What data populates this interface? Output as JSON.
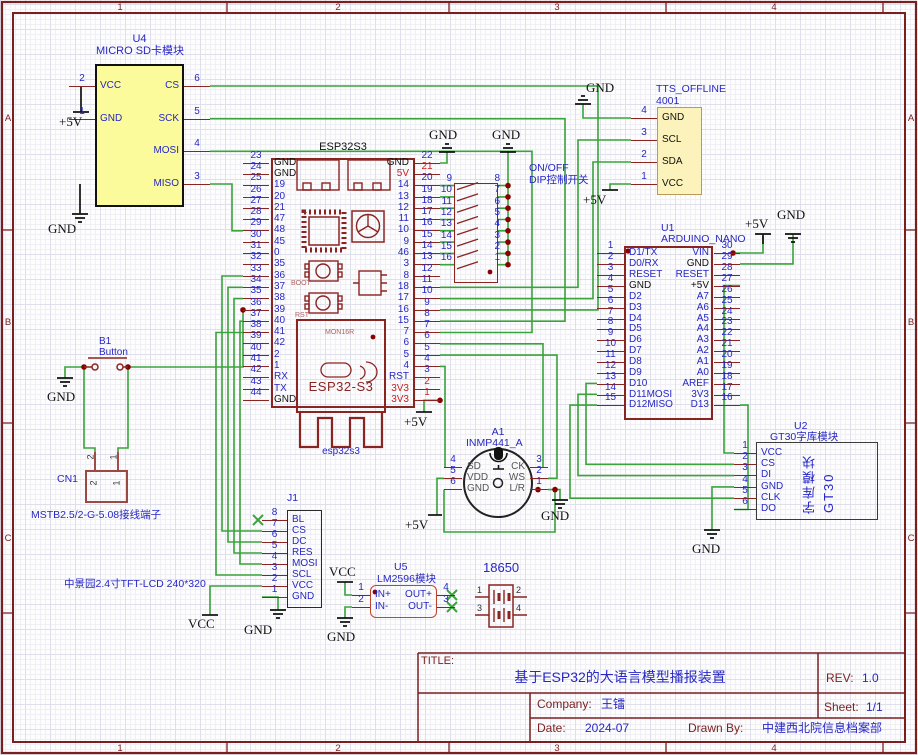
{
  "sheet": {
    "cols": [
      "1",
      "2",
      "3",
      "4"
    ],
    "rows": [
      "A",
      "B",
      "C"
    ]
  },
  "nets": {
    "gnd": "GND",
    "p5v": "+5V",
    "vcc": "VCC"
  },
  "tb": {
    "title_label": "TITLE:",
    "title": "基于ESP32的大语言模型播报装置",
    "rev_label": "REV:",
    "rev": "1.0",
    "company_label": "Company:",
    "company": "王镭",
    "sheet_label": "Sheet:",
    "sheet": "1/1",
    "date_label": "Date:",
    "date": "2024-07",
    "drawn_label": "Drawn By:",
    "drawn": "中建西北院信息档案部"
  },
  "u4": {
    "ref": "U4",
    "name": "MICRO SD卡模块",
    "left": [
      {
        "n": "2",
        "l": "VCC"
      },
      {
        "n": "1",
        "l": "GND"
      }
    ],
    "right": [
      {
        "n": "6",
        "l": "CS"
      },
      {
        "n": "5",
        "l": "SCK"
      },
      {
        "n": "4",
        "l": "MOSI"
      },
      {
        "n": "3",
        "l": "MISO"
      }
    ]
  },
  "esp32": {
    "header": "ESP32S3",
    "module_text": "ESP32-S3",
    "module_sub": "esp32s3",
    "logo_text": "MON16R",
    "boot": "BOOT",
    "rst": "RST",
    "left": [
      {
        "n": "23",
        "l": "GND",
        "lc": "k"
      },
      {
        "n": "24",
        "l": "GND",
        "lc": "k"
      },
      {
        "n": "25",
        "l": "19"
      },
      {
        "n": "26",
        "l": "20"
      },
      {
        "n": "27",
        "l": "21"
      },
      {
        "n": "28",
        "l": "47"
      },
      {
        "n": "29",
        "l": "48"
      },
      {
        "n": "30",
        "l": "45"
      },
      {
        "n": "31",
        "l": "0"
      },
      {
        "n": "32",
        "l": "35"
      },
      {
        "n": "33",
        "l": "36"
      },
      {
        "n": "34",
        "l": "37"
      },
      {
        "n": "35",
        "l": "38"
      },
      {
        "n": "36",
        "l": "39"
      },
      {
        "n": "37",
        "l": "40"
      },
      {
        "n": "38",
        "l": "41"
      },
      {
        "n": "39",
        "l": "42"
      },
      {
        "n": "40",
        "l": "2"
      },
      {
        "n": "41",
        "l": "1"
      },
      {
        "n": "42",
        "l": "RX"
      },
      {
        "n": "43",
        "l": "TX"
      },
      {
        "n": "44",
        "l": "GND",
        "lc": "k"
      }
    ],
    "right": [
      {
        "n": "22",
        "l": "GND",
        "lc": "k"
      },
      {
        "n": "21",
        "l": "5V",
        "nc": "r",
        "lc": "r"
      },
      {
        "n": "20",
        "l": "14"
      },
      {
        "n": "19",
        "l": "13"
      },
      {
        "n": "18",
        "l": "12"
      },
      {
        "n": "17",
        "l": "11"
      },
      {
        "n": "16",
        "l": "10"
      },
      {
        "n": "15",
        "l": "9"
      },
      {
        "n": "14",
        "l": "46"
      },
      {
        "n": "13",
        "l": "3"
      },
      {
        "n": "12",
        "l": "8"
      },
      {
        "n": "11",
        "l": "18"
      },
      {
        "n": "10",
        "l": "17"
      },
      {
        "n": "9",
        "l": "16"
      },
      {
        "n": "8",
        "l": "15"
      },
      {
        "n": "7",
        "l": "7"
      },
      {
        "n": "6",
        "l": "6"
      },
      {
        "n": "5",
        "l": "5"
      },
      {
        "n": "4",
        "l": "4"
      },
      {
        "n": "3",
        "l": "RST"
      },
      {
        "n": "2",
        "l": "3V3",
        "nc": "r",
        "lc": "r"
      },
      {
        "n": "1",
        "l": "3V3",
        "nc": "r",
        "lc": "r"
      }
    ]
  },
  "dip": {
    "label1": "ON/OFF",
    "label2": "DIP控制开关",
    "left": [
      {
        "n": "9"
      },
      {
        "n": "10"
      },
      {
        "n": "11"
      },
      {
        "n": "12"
      },
      {
        "n": "13"
      },
      {
        "n": "14"
      },
      {
        "n": "15"
      },
      {
        "n": "16"
      }
    ],
    "right": [
      {
        "n": "8"
      },
      {
        "n": "7"
      },
      {
        "n": "6"
      },
      {
        "n": "5"
      },
      {
        "n": "4"
      },
      {
        "n": "3"
      },
      {
        "n": "2"
      },
      {
        "n": "1"
      }
    ]
  },
  "tts": {
    "ref": "TTS_OFFLINE",
    "name": "4001",
    "pins": [
      {
        "n": "4",
        "l": "GND",
        "lc": "k"
      },
      {
        "n": "3",
        "l": "SCL",
        "lc": "k"
      },
      {
        "n": "2",
        "l": "SDA",
        "lc": "k"
      },
      {
        "n": "1",
        "l": "VCC",
        "lc": "k"
      }
    ]
  },
  "arduino": {
    "ref": "U1",
    "name": "ARDUINO_NANO",
    "left": [
      {
        "n": "1",
        "l": "D1/TX"
      },
      {
        "n": "2",
        "l": "D0/RX"
      },
      {
        "n": "3",
        "l": "RESET"
      },
      {
        "n": "4",
        "l": "GND",
        "lc": "k"
      },
      {
        "n": "5",
        "l": "D2"
      },
      {
        "n": "6",
        "l": "D3"
      },
      {
        "n": "7",
        "l": "D4"
      },
      {
        "n": "8",
        "l": "D5"
      },
      {
        "n": "9",
        "l": "D6"
      },
      {
        "n": "10",
        "l": "D7"
      },
      {
        "n": "11",
        "l": "D8"
      },
      {
        "n": "12",
        "l": "D9"
      },
      {
        "n": "13",
        "l": "D10"
      },
      {
        "n": "14",
        "l": "D11MOSI"
      },
      {
        "n": "15",
        "l": "D12MISO"
      }
    ],
    "right": [
      {
        "n": "30",
        "l": "VIN"
      },
      {
        "n": "29",
        "l": "GND",
        "lc": "k"
      },
      {
        "n": "28",
        "l": "RESET"
      },
      {
        "n": "27",
        "l": "+5V",
        "lc": "k"
      },
      {
        "n": "26",
        "l": "A7"
      },
      {
        "n": "25",
        "l": "A6"
      },
      {
        "n": "24",
        "l": "A5"
      },
      {
        "n": "23",
        "l": "A4"
      },
      {
        "n": "22",
        "l": "A3"
      },
      {
        "n": "21",
        "l": "A2"
      },
      {
        "n": "20",
        "l": "A1"
      },
      {
        "n": "19",
        "l": "A0"
      },
      {
        "n": "18",
        "l": "AREF"
      },
      {
        "n": "17",
        "l": "3V3"
      },
      {
        "n": "16",
        "l": "D13"
      }
    ]
  },
  "gt30": {
    "ref": "U2",
    "name": "GT30字库模块",
    "body1": "字库模块",
    "body2": "GT30",
    "pins": [
      {
        "n": "1",
        "l": "VCC"
      },
      {
        "n": "2",
        "l": "CS"
      },
      {
        "n": "3",
        "l": "DI"
      },
      {
        "n": "4",
        "l": "GND"
      },
      {
        "n": "5",
        "l": "CLK"
      },
      {
        "n": "6",
        "l": "DO"
      }
    ]
  },
  "mic": {
    "ref": "A1",
    "name": "INMP441_A",
    "left": [
      {
        "n": "4",
        "l": "SD",
        "lc": "g"
      },
      {
        "n": "5",
        "l": "VDD",
        "lc": "g"
      },
      {
        "n": "6",
        "l": "GND",
        "lc": "g"
      }
    ],
    "right": [
      {
        "n": "3",
        "l": "CK",
        "lc": "g"
      },
      {
        "n": "2",
        "l": "WS",
        "lc": "g"
      },
      {
        "n": "1",
        "l": "L/R",
        "lc": "g"
      }
    ]
  },
  "button": {
    "ref": "B1",
    "name": "Button"
  },
  "cn1": {
    "ref": "CN1",
    "desc": "MSTB2.5/2-G-5.08接线端子",
    "p2": "2",
    "p1": "1"
  },
  "j1": {
    "ref": "J1",
    "desc": "中景园2.4寸TFT-LCD 240*320",
    "pins": [
      {
        "n": "8",
        "l": "BL"
      },
      {
        "n": "7",
        "l": "CS"
      },
      {
        "n": "6",
        "l": "DC"
      },
      {
        "n": "5",
        "l": "RES"
      },
      {
        "n": "4",
        "l": "MOSI"
      },
      {
        "n": "3",
        "l": "SCL"
      },
      {
        "n": "2",
        "l": "VCC"
      },
      {
        "n": "1",
        "l": "GND"
      }
    ]
  },
  "u5": {
    "ref": "U5",
    "name": "LM2596模块",
    "left": [
      {
        "n": "1",
        "l": "IN+"
      },
      {
        "n": "2",
        "l": "IN-"
      }
    ],
    "right": [
      {
        "n": "4",
        "l": "OUT+"
      },
      {
        "n": "3",
        "l": "OUT-"
      }
    ]
  },
  "battery": {
    "name": "18650",
    "p1": "1",
    "p2": "2",
    "p3": "3",
    "p4": "4"
  }
}
